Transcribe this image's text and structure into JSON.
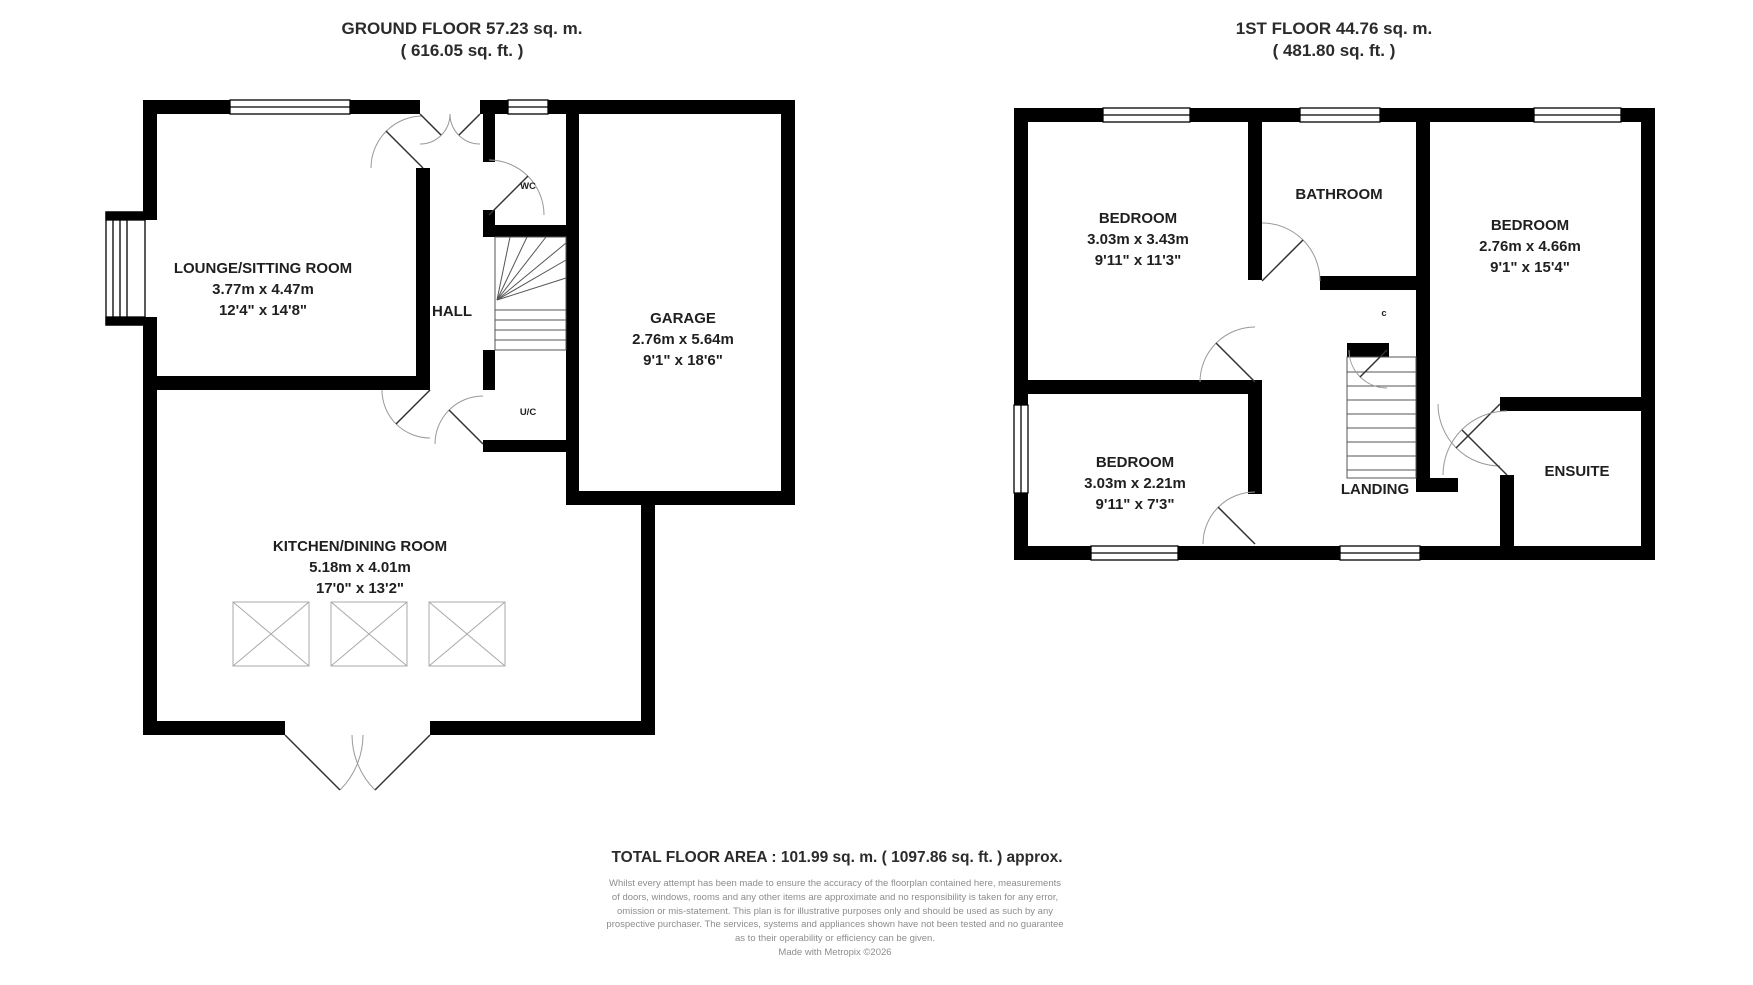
{
  "titles": {
    "ground": {
      "line1": "GROUND FLOOR 57.23 sq. m.",
      "line2": "( 616.05 sq. ft. )"
    },
    "first": {
      "line1": "1ST FLOOR 44.76 sq. m.",
      "line2": "( 481.80 sq. ft. )"
    }
  },
  "ground_floor": {
    "rooms": [
      {
        "id": "lounge",
        "name": "LOUNGE/SITTING ROOM",
        "metric": "3.77m x 4.47m",
        "imperial": "12'4\" x 14'8\""
      },
      {
        "id": "hall",
        "name": "HALL"
      },
      {
        "id": "wc",
        "name": "WC"
      },
      {
        "id": "uc",
        "name": "U/C"
      },
      {
        "id": "garage",
        "name": "GARAGE",
        "metric": "2.76m x 5.64m",
        "imperial": "9'1\" x 18'6\""
      },
      {
        "id": "kitchen",
        "name": "KITCHEN/DINING ROOM",
        "metric": "5.18m x 4.01m",
        "imperial": "17'0\" x 13'2\""
      }
    ]
  },
  "first_floor": {
    "rooms": [
      {
        "id": "bedroom1",
        "name": "BEDROOM",
        "metric": "3.03m x 3.43m",
        "imperial": "9'11\" x 11'3\""
      },
      {
        "id": "bathroom",
        "name": "BATHROOM"
      },
      {
        "id": "bedroom2",
        "name": "BEDROOM",
        "metric": "2.76m x 4.66m",
        "imperial": "9'1\" x 15'4\""
      },
      {
        "id": "bedroom3",
        "name": "BEDROOM",
        "metric": "3.03m x 2.21m",
        "imperial": "9'11\" x 7'3\""
      },
      {
        "id": "landing",
        "name": "LANDING"
      },
      {
        "id": "ensuite",
        "name": "ENSUITE"
      },
      {
        "id": "cupboard",
        "name": "c"
      }
    ]
  },
  "footer": {
    "total": "TOTAL FLOOR AREA : 101.99 sq. m. ( 1097.86 sq. ft. ) approx.",
    "disclaimer_lines": [
      "Whilst every attempt has been made to ensure the accuracy of the floorplan contained here, measurements",
      "of doors, windows, rooms and any other items are approximate and no responsibility is taken for any error,",
      "omission or mis-statement. This plan is for illustrative purposes only and should be used as such by any",
      "prospective purchaser. The services, systems and appliances shown have not been tested and no guarantee",
      "as to their operability or efficiency can be given.",
      "Made with Metropix ©2026"
    ]
  },
  "colors": {
    "wall": "#000000",
    "label_text": "#1f1f1f",
    "title_text": "#2b2b2b",
    "disclaimer_text": "#8d8d8d",
    "door_arc": "#999999",
    "door_leaf": "#333333",
    "stair_line": "#555555",
    "window_frame": "#000000",
    "background": "#ffffff"
  }
}
